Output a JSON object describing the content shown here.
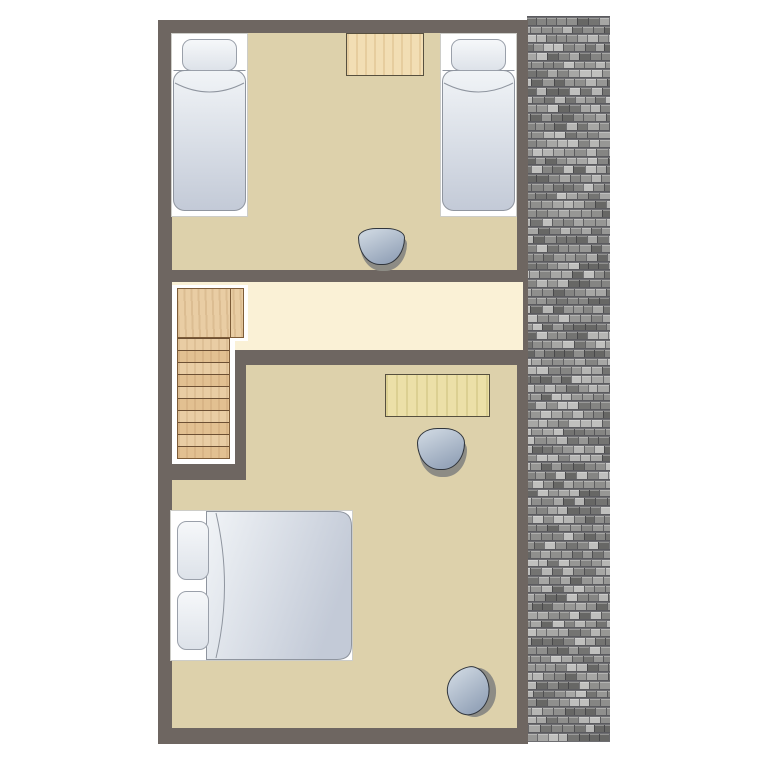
{
  "floor_plan": {
    "type": "residential-upper-floor-plan",
    "orientation": "portrait",
    "rooms": [
      {
        "id": "bedroom-top",
        "label": "twin bedroom",
        "furniture": [
          "single-bed-left",
          "desk",
          "single-bed-right",
          "stool"
        ]
      },
      {
        "id": "hallway",
        "label": "landing hallway",
        "furniture": [
          "staircase-with-landing"
        ],
        "features": [
          "window-right-end"
        ]
      },
      {
        "id": "bedroom-bottom",
        "label": "double bedroom",
        "furniture": [
          "desk",
          "stool",
          "double-bed",
          "corner-stool"
        ]
      }
    ],
    "staircase": {
      "steps": 10,
      "landing": true
    },
    "beds": {
      "single_count": 2,
      "double_count": 1,
      "double_pillows": 2
    },
    "roof": {
      "texture": "asphalt-shingles",
      "rows": 83,
      "palette": [
        "#b6b6b4",
        "#a7a7a5",
        "#979795",
        "#858583",
        "#747472",
        "#676765",
        "#8f8f8d",
        "#c0c0be"
      ],
      "gap_color": "#5b5b5f",
      "base_color": "#6e6e72"
    },
    "colors": {
      "background": "#ffffff",
      "wall": "#6e6661",
      "room_floor": "#ddd1ab",
      "hallway_floor": "#faf1d6",
      "stair_wood": "#e9cda4",
      "stair_wood_dark": "#e2c091",
      "stair_line": "#6d5034",
      "stair_border": "#7d5c38",
      "desk_top_wood": "#f2deb4",
      "desk_bottom_wood": "#ece0a8",
      "desk_border": "#57503f",
      "bed_frame": "#ffffff",
      "bed_outline": "#8f959f",
      "mattress_light": "#f1f4f7",
      "mattress_dark": "#c3cad7",
      "pillow_light": "#f6f8fa",
      "pillow_dark": "#dde2e9",
      "stool_light": "#c8d2dd",
      "stool_dark": "#96a5ba",
      "stool_outline": "#30353c",
      "stool_shadow": "#8d8c85"
    }
  }
}
